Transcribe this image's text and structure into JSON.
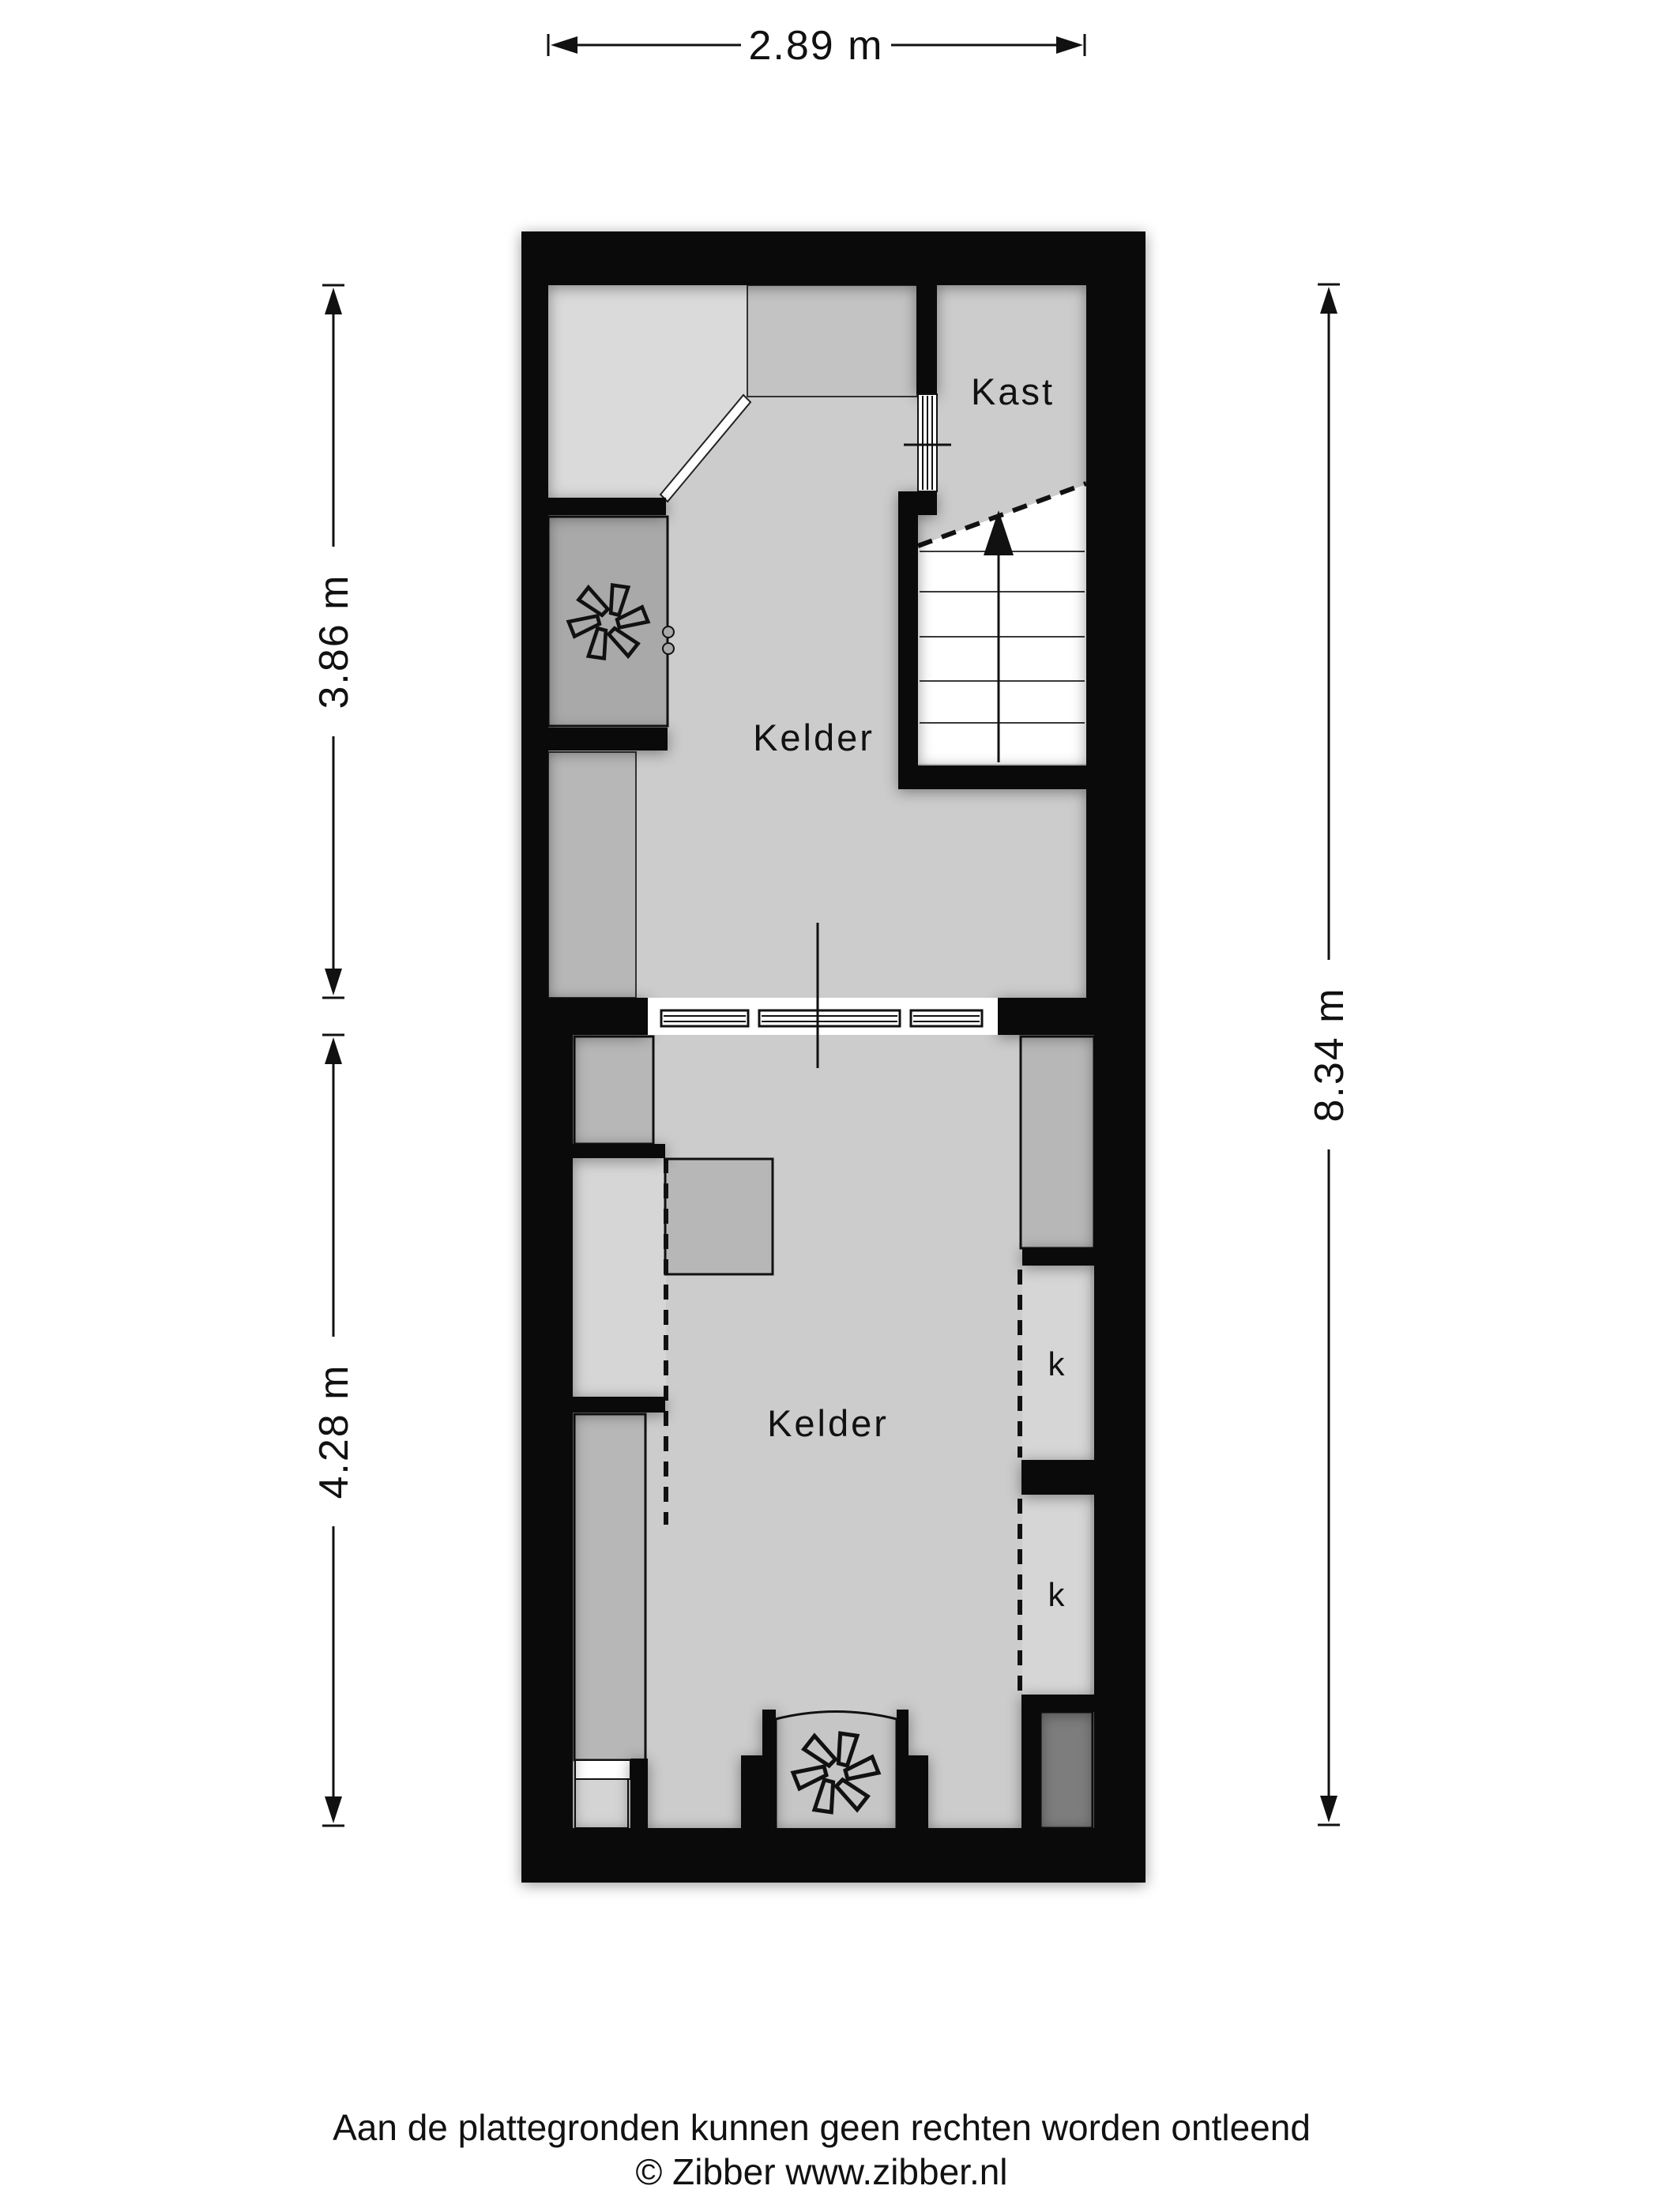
{
  "colors": {
    "wall": "#0a0a0a",
    "ink": "#111111",
    "floor": "#cccccc",
    "room-light": "#dadada",
    "room-mid": "#c3c3c3",
    "room-dark": "#a9a9a9",
    "room-darker": "#7d7d7d",
    "furniture": "#b7b7b7",
    "niche": "#d6d6d6",
    "alcove": "#c6c6c6",
    "stair": "#ffffff"
  },
  "plan": {
    "rooms": [
      {
        "name": "kelder-upper",
        "label": "Kelder"
      },
      {
        "name": "kast",
        "label": "Kast"
      },
      {
        "name": "kelder-lower",
        "label": "Kelder"
      },
      {
        "name": "closet-upper",
        "label": "k"
      },
      {
        "name": "closet-lower",
        "label": "k"
      }
    ]
  },
  "dimensions": {
    "top": "2.89 m",
    "left_upper": "3.86 m",
    "left_lower": "4.28 m",
    "right": "8.34 m"
  },
  "footer": {
    "disclaimer": "Aan de plattegronden kunnen geen rechten worden ontleend",
    "copyright": "© Zibber www.zibber.nl"
  }
}
